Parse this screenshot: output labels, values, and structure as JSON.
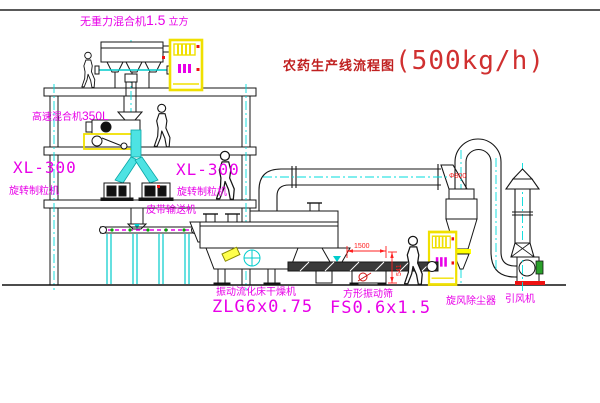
{
  "title": {
    "text": "农药生产线流程图",
    "capacity": "(500kg/h)"
  },
  "equipment": {
    "gravity_mixer": {
      "name": "无重力混合机",
      "size": "1.5",
      "unit": "立方"
    },
    "high_speed_mixer": {
      "name": "高速混合机",
      "size": "350L"
    },
    "granulator_left": {
      "model": "XL-300",
      "name": "旋转制粒机"
    },
    "granulator_right": {
      "model": "XL-300",
      "name": "旋转制粒机"
    },
    "belt_conveyor": {
      "name": "皮带输送机"
    },
    "dryer": {
      "name": "振动流化床干燥机",
      "model": "ZLG6x0.75"
    },
    "sieve": {
      "name": "方形振动筛",
      "model": "FS0.6x1.5",
      "dim_width": "1500",
      "dim_height": "541"
    },
    "cyclone": {
      "name": "旋风除尘器",
      "dim": "Φ800"
    },
    "fan": {
      "name": "引风机"
    }
  },
  "colors": {
    "label_magenta": "#e800e8",
    "title_red": "#c63030",
    "dimension_red": "#ff2020",
    "centerline_cyan": "#00dcdc",
    "cabinet_yellow": "#f0e000"
  }
}
